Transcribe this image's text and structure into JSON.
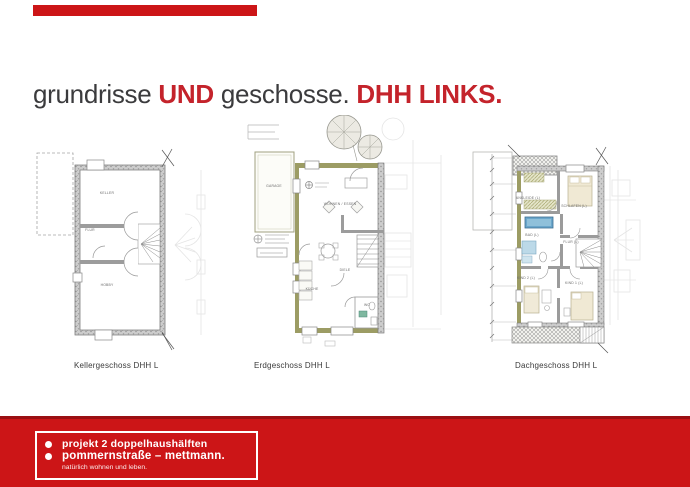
{
  "slide": {
    "background": "#ffffff",
    "accent_red": "#cc1517",
    "accent_red_dark": "#9a0f12",
    "title_dark": "#3b3b3d",
    "title_red": "#c4232b"
  },
  "title": {
    "word1": "grundrisse",
    "word2": "UND",
    "word3": "geschosse.",
    "word4": "DHH LINKS."
  },
  "plans": [
    {
      "caption": "Kellergeschoss DHH L",
      "rooms": {
        "top": "KELLER",
        "middle": "FLUR",
        "bottom": "HOBBY"
      }
    },
    {
      "caption": "Erdgeschoss DHH L",
      "rooms": {
        "garage": "GARAGE",
        "living": "WOHNEN / ESSEN",
        "kitchen": "KÜCHE",
        "hall": "DIELE",
        "wc": "WC"
      }
    },
    {
      "caption": "Dachgeschoss DHH L",
      "rooms": {
        "ankleide": "ANKLEIDE (L)",
        "schlafen": "SCHLAFEN (L)",
        "bad": "BAD (L)",
        "flur": "FLUR (L)",
        "kind2": "KIND 2 (L)",
        "kind1": "KIND 1 (L)"
      }
    }
  ],
  "footer": {
    "line1": "projekt 2 doppelhaushälften",
    "line2": "pommernstraße – mettmann.",
    "line3": "natürlich wohnen und leben."
  }
}
